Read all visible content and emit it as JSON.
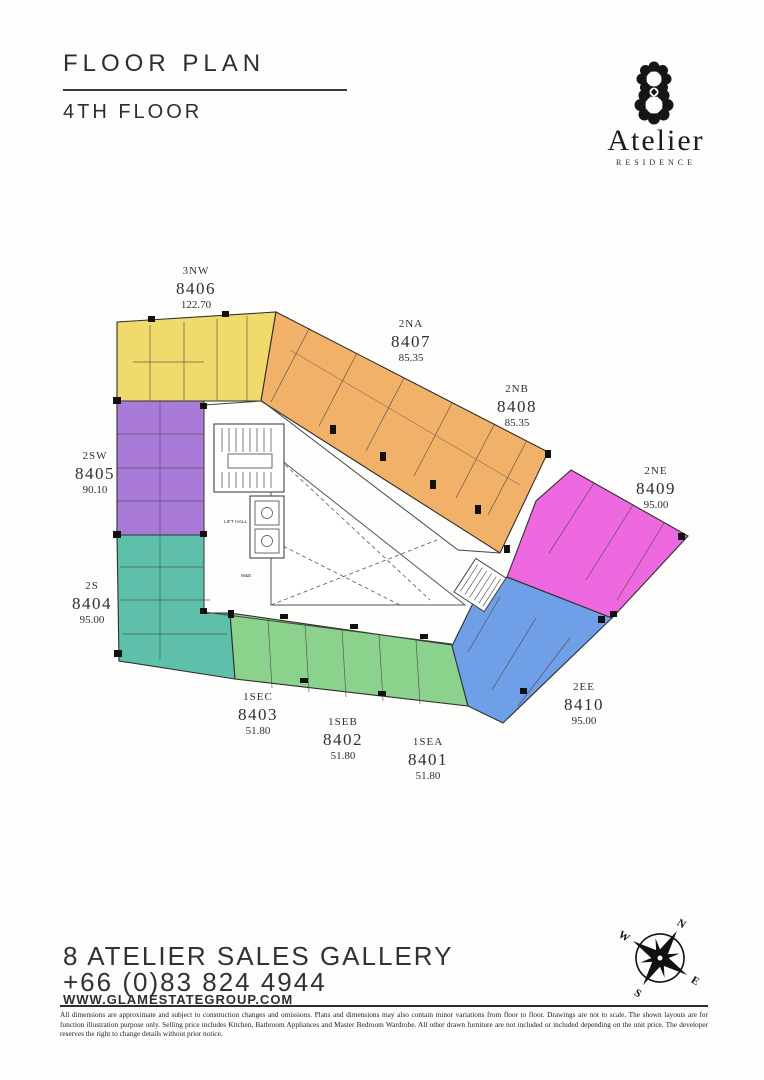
{
  "header": {
    "title": "FLOOR PLAN",
    "subtitle": "4TH FLOOR"
  },
  "brand": {
    "name": "Atelier",
    "tagline": "RESIDENCE"
  },
  "plan": {
    "zones": [
      {
        "zone": "north-west-yellow",
        "color": "#f1da6c"
      },
      {
        "zone": "north-orange",
        "color": "#f2b168"
      },
      {
        "zone": "south-west-purple",
        "color": "#a97ad7"
      },
      {
        "zone": "south-teal",
        "color": "#5ec0ab"
      },
      {
        "zone": "south-east-green",
        "color": "#8bd28d"
      },
      {
        "zone": "east-blue",
        "color": "#6f9fe7"
      },
      {
        "zone": "north-east-magenta",
        "color": "#ee68e0"
      }
    ],
    "units": [
      {
        "code": "3NW",
        "number": "8406",
        "area": "122.70"
      },
      {
        "code": "2NA",
        "number": "8407",
        "area": "85.35"
      },
      {
        "code": "2NB",
        "number": "8408",
        "area": "85.35"
      },
      {
        "code": "2NE",
        "number": "8409",
        "area": "95.00"
      },
      {
        "code": "2SW",
        "number": "8405",
        "area": "90.10"
      },
      {
        "code": "2S",
        "number": "8404",
        "area": "95.00"
      },
      {
        "code": "1SEC",
        "number": "8403",
        "area": "51.80"
      },
      {
        "code": "1SEB",
        "number": "8402",
        "area": "51.80"
      },
      {
        "code": "1SEA",
        "number": "8401",
        "area": "51.80"
      },
      {
        "code": "2EE",
        "number": "8410",
        "area": "95.00"
      }
    ],
    "core_labels": {
      "lift_hall": "LIFT HALL",
      "mne": "M&E"
    }
  },
  "compass": {
    "n": "N",
    "e": "E",
    "s": "S",
    "w": "W"
  },
  "footer": {
    "gallery": "8 ATELIER SALES GALLERY",
    "phone": "+66 (0)83 824 4944",
    "website": "WWW.GLAMESTATEGROUP.COM",
    "disclaimer": "All dimensions are approximate and subject to construction changes and omissions. Plans and dimensions may also contain minor variations from floor to floor. Drawings are not to scale. The shown layouts are for function illustration purpose only. Selling price includes Kitchen, Bathroom Appliances and Master Bedroom Wardrobe. All other drawn furniture are not included or included depending on the unit price. The developer reserves the right to change details without prior notice."
  }
}
